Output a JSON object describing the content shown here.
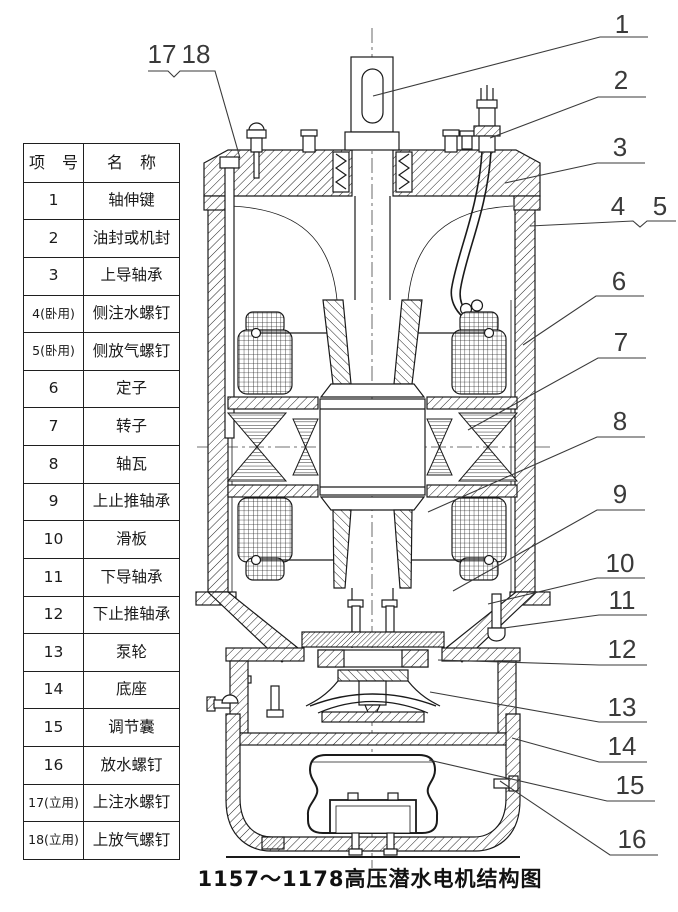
{
  "parts_table": {
    "headers": {
      "no": "项 号",
      "name": "名 称"
    },
    "rows": [
      {
        "no": "1",
        "name": "轴伸键"
      },
      {
        "no": "2",
        "name": "油封或机封"
      },
      {
        "no": "3",
        "name": "上导轴承"
      },
      {
        "no": "4(卧用)",
        "name": "侧注水螺钉"
      },
      {
        "no": "5(卧用)",
        "name": "侧放气螺钉"
      },
      {
        "no": "6",
        "name": "定子"
      },
      {
        "no": "7",
        "name": "转子"
      },
      {
        "no": "8",
        "name": "轴瓦"
      },
      {
        "no": "9",
        "name": "上止推轴承"
      },
      {
        "no": "10",
        "name": "滑板"
      },
      {
        "no": "11",
        "name": "下导轴承"
      },
      {
        "no": "12",
        "name": "下止推轴承"
      },
      {
        "no": "13",
        "name": "泵轮"
      },
      {
        "no": "14",
        "name": "底座"
      },
      {
        "no": "15",
        "name": "调节囊"
      },
      {
        "no": "16",
        "name": "放水螺钉"
      },
      {
        "no": "17(立用)",
        "name": "上注水螺钉"
      },
      {
        "no": "18(立用)",
        "name": "上放气螺钉"
      }
    ]
  },
  "callouts": [
    "1",
    "2",
    "3",
    "4",
    "5",
    "6",
    "7",
    "8",
    "9",
    "10",
    "11",
    "12",
    "13",
    "14",
    "15",
    "16",
    "17",
    "18"
  ],
  "caption": "1157～1178高压潜水电机结构图",
  "colors": {
    "line": "#1a1a1a",
    "leader": "#3a3a3a",
    "background": "#ffffff"
  }
}
